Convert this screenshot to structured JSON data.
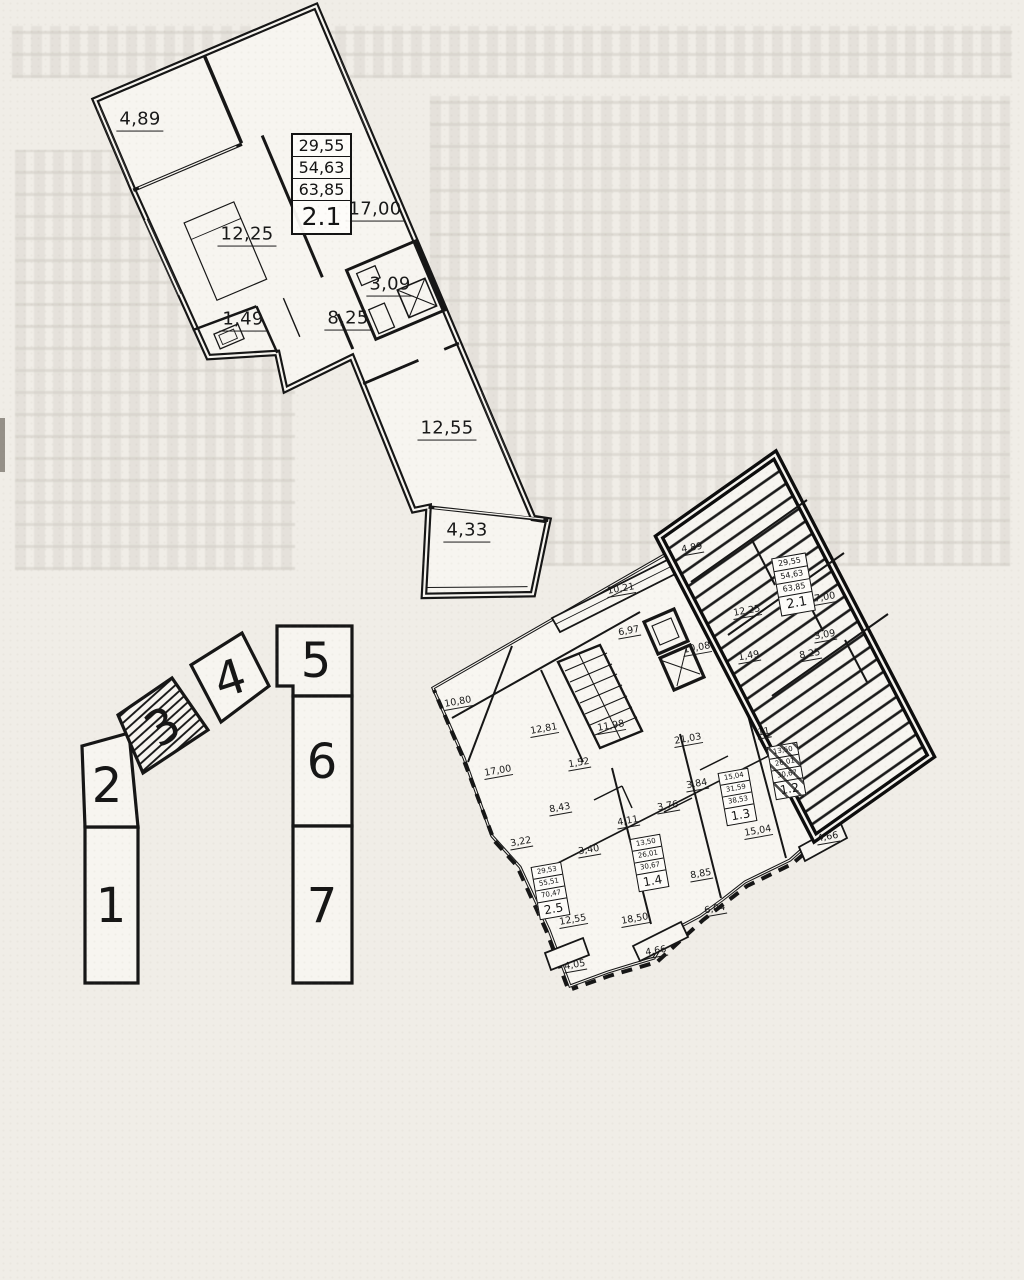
{
  "apartment_plan": {
    "info_table": {
      "row1": "29,55",
      "row2": "54,63",
      "row3": "63,85",
      "unit": "2.1"
    },
    "dims": {
      "balcony_top": "4,89",
      "bedroom": "12,25",
      "living_room": "17,00",
      "bathroom": "3,09",
      "wc": "1,49",
      "hall": "8,25",
      "room_lower": "12,55",
      "balcony_bottom": "4,33"
    }
  },
  "site_key_plan": {
    "sections": [
      "1",
      "2",
      "3",
      "4",
      "5",
      "6",
      "7"
    ],
    "highlighted_section": "3"
  },
  "floor_plan": {
    "unit_tables": [
      {
        "rows": [
          "29,55",
          "54,63",
          "63,85"
        ],
        "label": "2.1"
      },
      {
        "rows": [
          "29,53",
          "55,51",
          "70,47"
        ],
        "label": "2.5"
      },
      {
        "rows": [
          "13,50",
          "26,01",
          "30,67"
        ],
        "label": "1.4"
      },
      {
        "rows": [
          "15,04",
          "31,59",
          "38,53"
        ],
        "label": "1.3"
      },
      {
        "rows": [
          "13,50",
          "26,01",
          "30,67"
        ],
        "label": "1.2"
      }
    ],
    "dims": [
      {
        "text": "4,89"
      },
      {
        "text": "10,21"
      },
      {
        "text": "6,97"
      },
      {
        "text": "10,08"
      },
      {
        "text": "12,25"
      },
      {
        "text": "17,00"
      },
      {
        "text": "1,49"
      },
      {
        "text": "8,25"
      },
      {
        "text": "3,09"
      },
      {
        "text": "10,80"
      },
      {
        "text": "12,81"
      },
      {
        "text": "11,98"
      },
      {
        "text": "21,03"
      },
      {
        "text": "11"
      },
      {
        "text": "1,52"
      },
      {
        "text": "17,00"
      },
      {
        "text": "8,43"
      },
      {
        "text": "4,11"
      },
      {
        "text": "3,22"
      },
      {
        "text": "3,40"
      },
      {
        "text": "3,76"
      },
      {
        "text": "3,84"
      },
      {
        "text": "15,04"
      },
      {
        "text": "8,85"
      },
      {
        "text": "6,04"
      },
      {
        "text": "18,50"
      },
      {
        "text": "12,55"
      },
      {
        "text": "4,05"
      },
      {
        "text": "4,66"
      },
      {
        "text": "4,66"
      }
    ]
  }
}
